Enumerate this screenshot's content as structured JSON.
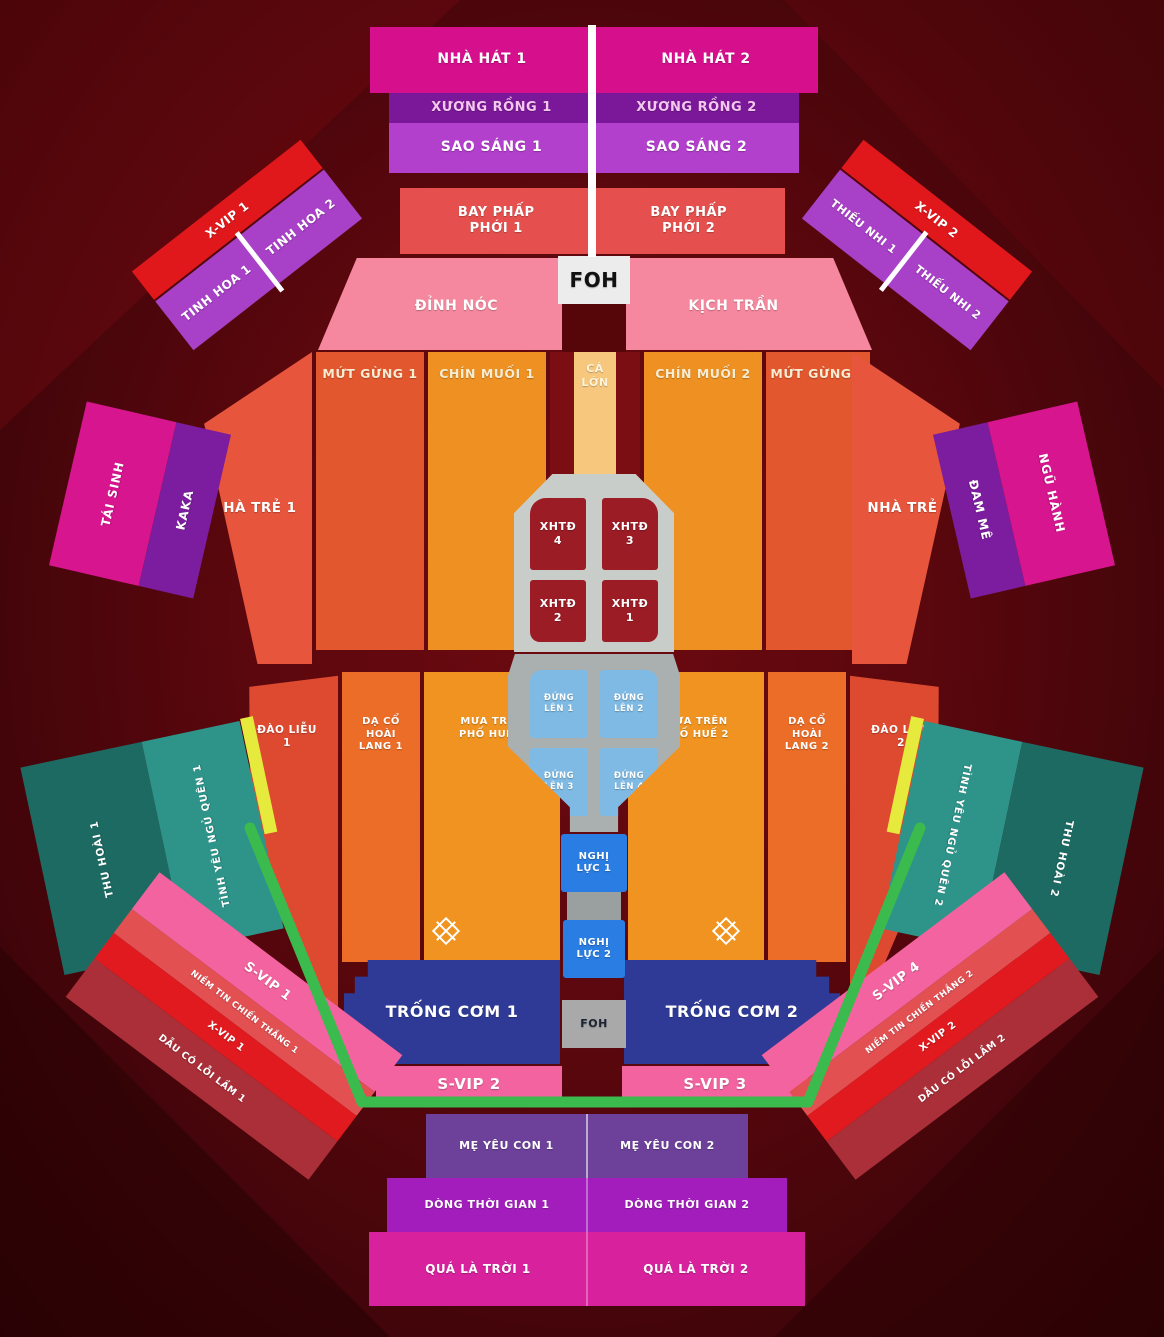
{
  "map_title": "concert-seating-map",
  "palette": {
    "background": "#5a070d",
    "magenta": "#d60f8d",
    "dark_purple": "#7b189a",
    "purple": "#b33fcd",
    "violet": "#a841c8",
    "salmon_red": "#e5504e",
    "pink": "#f5889e",
    "svip_pink": "#f2639f",
    "orange_dark": "#e2572e",
    "orange": "#ee9122",
    "orange_light": "#f6c77d",
    "red_orange": "#e6553c",
    "red": "#e0181c",
    "dark_red_block": "#9c1c26",
    "maroon_red": "#aa2f38",
    "navy": "#2e3a96",
    "blue": "#2a7de2",
    "light_blue": "#7ebae4",
    "gray_stage": "#c9cdc9",
    "gray_shield": "#aab0b0",
    "teal_dark": "#1d6a63",
    "teal_light": "#2e948a",
    "fence_green": "#3bbb4d",
    "yellow_strip": "#e5ea3d",
    "bottom_purple": "#6d4199",
    "bottom_violet": "#a31dbd",
    "bottom_magenta": "#d7219d",
    "white": "#ffffff"
  },
  "stage": {
    "foh_top": "FOH",
    "foh_bottom": "FOH"
  },
  "sections": {
    "nha_hat_1": "NHÀ HÁT 1",
    "nha_hat_2": "NHÀ HÁT 2",
    "xuong_rong_1": "XƯƠNG RỒNG 1",
    "xuong_rong_2": "XƯƠNG RỒNG 2",
    "sao_sang_1": "SAO SÁNG 1",
    "sao_sang_2": "SAO SÁNG 2",
    "bay_phap_phoi_1": "BAY PHẤP PHỚI 1",
    "bay_phap_phoi_2": "BAY PHẤP PHỚI 2",
    "dinh_noc": "ĐỈNH NÓC",
    "kich_tran": "KỊCH TRẦN",
    "mut_gung_1": "MỨT GỪNG 1",
    "mut_gung_2": "MỨT GỪNG 2",
    "chin_muoi_1": "CHÍN MUỐI 1",
    "chin_muoi_2": "CHÍN MUỐI 2",
    "ca_lon": "CÁ LỚN",
    "nha_tre_1": "NHÀ TRẺ 1",
    "nha_tre_2": "NHÀ TRẺ 2",
    "x_vip_1_upper": "X-VIP 1",
    "x_vip_2_upper": "X-VIP 2",
    "tinh_hoa_1": "TINH HOA 1",
    "tinh_hoa_2": "TINH HOA 2",
    "thieu_nhi_1": "THIẾU NHI 1",
    "thieu_nhi_2": "THIẾU NHI 2",
    "tai_sinh": "TÁI SINH",
    "kaka": "KAKA",
    "dam_me": "ĐAM MÊ",
    "ngu_hanh": "NGŨ HÀNH",
    "xhtd_1": "XHTĐ 1",
    "xhtd_2": "XHTĐ 2",
    "xhtd_3": "XHTĐ 3",
    "xhtd_4": "XHTĐ 4",
    "dung_len_1": "ĐỨNG LÊN 1",
    "dung_len_2": "ĐỨNG LÊN 2",
    "dung_len_3": "ĐỨNG LÊN 3",
    "dung_len_4": "ĐỨNG LÊN 4",
    "dao_lieu_1": "ĐÀO LIỄU 1",
    "dao_lieu_2": "ĐÀO LIỄU 2",
    "da_co_hoai_lang_1": "DẠ CỔ HOÀI LANG 1",
    "da_co_hoai_lang_2": "DẠ CỔ HOÀI LANG 2",
    "mua_tren_pho_hue_1": "MƯA TRÊN PHỐ HUẾ 1",
    "mua_tren_pho_hue_2": "MƯA TRÊN PHỐ HUẾ 2",
    "nghi_luc_1": "NGHỊ LỰC 1",
    "nghi_luc_2": "NGHỊ LỰC 2",
    "trong_com_1": "TRỐNG CƠM 1",
    "trong_com_2": "TRỐNG CƠM 2",
    "s_vip_1": "S-VIP 1",
    "s_vip_2": "S-VIP 2",
    "s_vip_3": "S-VIP 3",
    "s_vip_4": "S-VIP 4",
    "niem_tin_chien_thang_1": "NIỀM TIN CHIẾN THẮNG 1",
    "niem_tin_chien_thang_2": "NIỀM TIN CHIẾN THẮNG 2",
    "x_vip_1_lower": "X-VIP 1",
    "x_vip_2_lower": "X-VIP 2",
    "dau_co_loi_lam_1": "DẪU CÓ LỖI LẦM 1",
    "dau_co_loi_lam_2": "DẪU CÓ LỖI LẦM 2",
    "thu_hoai_1": "THU HOÀI 1",
    "thu_hoai_2": "THU HOÀI 2",
    "tinh_yeu_ngu_quen_1": "TÌNH YÊU NGỦ QUÊN 1",
    "tinh_yeu_ngu_quen_2": "TÌNH YÊU NGỦ QUÊN 2",
    "me_yeu_con_1": "MẸ YÊU CON 1",
    "me_yeu_con_2": "MẸ YÊU CON 2",
    "dong_thoi_gian_1": "DÒNG THỜI GIAN 1",
    "dong_thoi_gian_2": "DÒNG THỜI GIAN 2",
    "qua_la_troi_1": "QUÁ LÀ TRỜI 1",
    "qua_la_troi_2": "QUÁ LÀ TRỜI 2"
  }
}
